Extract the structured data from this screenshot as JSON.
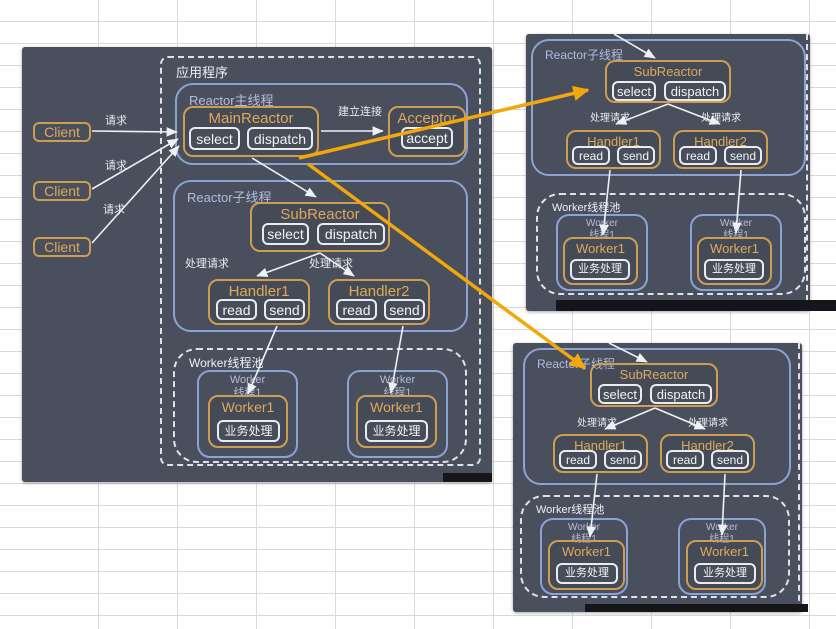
{
  "canvas": {
    "width": 836,
    "height": 629
  },
  "colors": {
    "panel_bg": "#4a4f5d",
    "orange_border": "#cf9d52",
    "orange_text": "#dfa958",
    "blue_border": "#8ba3d1",
    "blue_text": "#b0bddc",
    "white_text": "#eef0f3",
    "arrow_orange": "#f2a70a",
    "grid_line": "#d9d9d9"
  },
  "nodes": [
    {
      "t": "panel",
      "n": "main-diagram-panel",
      "r": [
        22,
        47,
        470,
        435
      ]
    },
    {
      "t": "strip",
      "n": "shadow-strip-main",
      "r": [
        443,
        473,
        49,
        9
      ]
    },
    {
      "t": "client",
      "n": "client-box-1",
      "tx": "Client",
      "r": [
        33,
        122,
        58,
        20
      ]
    },
    {
      "t": "client",
      "n": "client-box-2",
      "tx": "Client",
      "r": [
        33,
        181,
        58,
        20
      ]
    },
    {
      "t": "client",
      "n": "client-box-3",
      "tx": "Client",
      "r": [
        33,
        237,
        58,
        20
      ]
    },
    {
      "t": "text",
      "n": "request-label-1",
      "tx": "请求",
      "r": [
        100,
        113,
        32,
        13
      ]
    },
    {
      "t": "text",
      "n": "request-label-2",
      "tx": "请求",
      "r": [
        100,
        158,
        32,
        13
      ]
    },
    {
      "t": "text",
      "n": "request-label-3",
      "tx": "请求",
      "r": [
        98,
        202,
        32,
        13
      ]
    },
    {
      "t": "dashed",
      "n": "application-container",
      "tx": "应用程序",
      "r": [
        160,
        56,
        321,
        410
      ],
      "rad": 8
    },
    {
      "t": "blue",
      "n": "reactor-main-thread-container",
      "tx": "Reactor主线程",
      "r": [
        175,
        83,
        293,
        82
      ]
    },
    {
      "t": "orange",
      "n": "main-reactor-box",
      "tx": "MainReactor",
      "r": [
        183,
        106,
        136,
        51
      ],
      "fz": 15
    },
    {
      "t": "btn",
      "n": "select-button-main",
      "tx": "select",
      "r": [
        189,
        127,
        51,
        23
      ]
    },
    {
      "t": "btn",
      "n": "dispatch-button-main",
      "tx": "dispatch",
      "r": [
        247,
        127,
        66,
        23
      ]
    },
    {
      "t": "text",
      "n": "establish-connection-label",
      "tx": "建立连接",
      "r": [
        336,
        104,
        48,
        13
      ]
    },
    {
      "t": "orange",
      "n": "acceptor-box",
      "tx": "Acceptor",
      "r": [
        388,
        106,
        78,
        51
      ],
      "fz": 15
    },
    {
      "t": "btn",
      "n": "accept-button",
      "tx": "accept",
      "r": [
        401,
        127,
        52,
        22
      ]
    },
    {
      "t": "blue",
      "n": "reactor-sub-thread-container-main",
      "tx": "Reactor子线程",
      "r": [
        173,
        180,
        295,
        152
      ]
    },
    {
      "t": "orange",
      "n": "sub-reactor-box-main",
      "tx": "SubReactor",
      "r": [
        250,
        202,
        140,
        50
      ],
      "fz": 15
    },
    {
      "t": "btn",
      "n": "select-button-sub-main",
      "tx": "select",
      "r": [
        262,
        223,
        47,
        22
      ]
    },
    {
      "t": "btn",
      "n": "dispatch-button-sub-main",
      "tx": "dispatch",
      "r": [
        317,
        223,
        68,
        22
      ]
    },
    {
      "t": "text",
      "n": "handle-request-label-main-1",
      "tx": "处理请求",
      "r": [
        183,
        257,
        48,
        12
      ]
    },
    {
      "t": "text",
      "n": "handle-request-label-main-2",
      "tx": "处理请求",
      "r": [
        307,
        257,
        48,
        12
      ]
    },
    {
      "t": "orange",
      "n": "handler1-box-main",
      "tx": "Handler1",
      "r": [
        208,
        279,
        102,
        46
      ],
      "fz": 15
    },
    {
      "t": "btn",
      "n": "read-button-h1-main",
      "tx": "read",
      "r": [
        216,
        299,
        41,
        21
      ]
    },
    {
      "t": "btn",
      "n": "send-button-h1-main",
      "tx": "send",
      "r": [
        264,
        299,
        41,
        21
      ]
    },
    {
      "t": "orange",
      "n": "handler2-box-main",
      "tx": "Handler2",
      "r": [
        328,
        279,
        102,
        46
      ],
      "fz": 15
    },
    {
      "t": "btn",
      "n": "read-button-h2-main",
      "tx": "read",
      "r": [
        336,
        299,
        41,
        21
      ]
    },
    {
      "t": "btn",
      "n": "send-button-h2-main",
      "tx": "send",
      "r": [
        384,
        299,
        41,
        21
      ]
    },
    {
      "t": "dashed",
      "n": "worker-pool-main",
      "tx": "Worker线程池",
      "r": [
        173,
        348,
        294,
        115
      ],
      "fz": 12,
      "rad": 24
    },
    {
      "t": "bluebox",
      "n": "worker-thread-box-main-1",
      "tx": "Worker\n线程1",
      "r": [
        197,
        370,
        101,
        88
      ]
    },
    {
      "t": "orange",
      "n": "worker1-box-main-1",
      "tx": "Worker1",
      "r": [
        208,
        395,
        80,
        53
      ],
      "fz": 14
    },
    {
      "t": "btn",
      "n": "business-process-button-main-1",
      "tx": "业务处理",
      "r": [
        217,
        420,
        63,
        22
      ],
      "fz": 12
    },
    {
      "t": "bluebox",
      "n": "worker-thread-box-main-2",
      "tx": "Worker\n线程1",
      "r": [
        347,
        370,
        101,
        88
      ]
    },
    {
      "t": "orange",
      "n": "worker1-box-main-2",
      "tx": "Worker1",
      "r": [
        356,
        395,
        81,
        53
      ],
      "fz": 14
    },
    {
      "t": "btn",
      "n": "business-process-button-main-2",
      "tx": "业务处理",
      "r": [
        365,
        420,
        63,
        22
      ],
      "fz": 12
    },
    {
      "t": "panel",
      "n": "top-right-panel",
      "r": [
        526,
        34,
        284,
        277
      ]
    },
    {
      "t": "dashline",
      "n": "dashed-edge-top-right",
      "r": [
        806,
        34,
        3,
        277
      ]
    },
    {
      "t": "strip",
      "n": "shadow-strip-top-right",
      "r": [
        556,
        300,
        280,
        11
      ]
    },
    {
      "t": "blue",
      "n": "reactor-sub-thread-container-tr",
      "tx": "Reactor子线程",
      "r": [
        531,
        39,
        275,
        137
      ],
      "fz": 12
    },
    {
      "t": "orange",
      "n": "sub-reactor-box-tr",
      "tx": "SubReactor",
      "r": [
        605,
        60,
        126,
        43
      ],
      "fz": 13
    },
    {
      "t": "btn",
      "n": "select-button-tr",
      "tx": "select",
      "r": [
        612,
        81,
        44,
        20
      ],
      "fz": 13
    },
    {
      "t": "btn",
      "n": "dispatch-button-tr",
      "tx": "dispatch",
      "r": [
        664,
        81,
        62,
        20
      ],
      "fz": 13
    },
    {
      "t": "text",
      "n": "handle-request-label-tr-1",
      "tx": "处理请求",
      "r": [
        589,
        111,
        42,
        11
      ],
      "fz": 10
    },
    {
      "t": "text",
      "n": "handle-request-label-tr-2",
      "tx": "处理请求",
      "r": [
        700,
        111,
        42,
        11
      ],
      "fz": 10
    },
    {
      "t": "orange",
      "n": "handler1-box-tr",
      "tx": "Handler1",
      "r": [
        566,
        130,
        95,
        39
      ],
      "fz": 13
    },
    {
      "t": "btn",
      "n": "read-button-tr1",
      "tx": "read",
      "r": [
        572,
        146,
        38,
        19
      ],
      "fz": 12
    },
    {
      "t": "btn",
      "n": "send-button-tr1",
      "tx": "send",
      "r": [
        617,
        146,
        38,
        19
      ],
      "fz": 12
    },
    {
      "t": "orange",
      "n": "handler2-box-tr",
      "tx": "Handler2",
      "r": [
        673,
        130,
        95,
        39
      ],
      "fz": 13
    },
    {
      "t": "btn",
      "n": "read-button-tr2",
      "tx": "read",
      "r": [
        679,
        146,
        38,
        19
      ],
      "fz": 12
    },
    {
      "t": "btn",
      "n": "send-button-tr2",
      "tx": "send",
      "r": [
        724,
        146,
        38,
        19
      ],
      "fz": 12
    },
    {
      "t": "dashed",
      "n": "worker-pool-tr",
      "tx": "Worker线程池",
      "r": [
        536,
        193,
        270,
        102
      ],
      "fz": 11,
      "rad": 24
    },
    {
      "t": "bluebox",
      "n": "worker-thread-box-tr-1",
      "tx": "Worker\n线程1",
      "r": [
        556,
        214,
        92,
        77
      ],
      "fz": 10
    },
    {
      "t": "orange",
      "n": "worker1-box-tr-1",
      "tx": "Worker1",
      "r": [
        563,
        237,
        75,
        48
      ],
      "fz": 13
    },
    {
      "t": "btn",
      "n": "business-process-button-tr-1",
      "tx": "业务处理",
      "r": [
        570,
        259,
        60,
        21
      ],
      "fz": 11
    },
    {
      "t": "bluebox",
      "n": "worker-thread-box-tr-2",
      "tx": "Worker\n线程1",
      "r": [
        690,
        214,
        92,
        77
      ],
      "fz": 10
    },
    {
      "t": "orange",
      "n": "worker1-box-tr-2",
      "tx": "Worker1",
      "r": [
        697,
        237,
        75,
        48
      ],
      "fz": 13
    },
    {
      "t": "btn",
      "n": "business-process-button-tr-2",
      "tx": "业务处理",
      "r": [
        704,
        259,
        60,
        21
      ],
      "fz": 11
    },
    {
      "t": "panel",
      "n": "bottom-right-panel",
      "r": [
        513,
        343,
        289,
        269
      ]
    },
    {
      "t": "dashline",
      "n": "dashed-edge-bottom-right",
      "r": [
        798,
        343,
        3,
        268
      ]
    },
    {
      "t": "strip",
      "n": "shadow-strip-bottom-right",
      "r": [
        585,
        604,
        223,
        8
      ]
    },
    {
      "t": "blue",
      "n": "reactor-sub-thread-container-br",
      "tx": "Reactor子线程",
      "r": [
        523,
        348,
        268,
        137
      ],
      "fz": 12
    },
    {
      "t": "orange",
      "n": "sub-reactor-box-br",
      "tx": "SubReactor",
      "r": [
        590,
        363,
        128,
        44
      ],
      "fz": 13
    },
    {
      "t": "btn",
      "n": "select-button-br",
      "tx": "select",
      "r": [
        598,
        384,
        44,
        20
      ],
      "fz": 13
    },
    {
      "t": "btn",
      "n": "dispatch-button-br",
      "tx": "dispatch",
      "r": [
        650,
        384,
        62,
        20
      ],
      "fz": 13
    },
    {
      "t": "text",
      "n": "handle-request-label-br-1",
      "tx": "处理请求",
      "r": [
        576,
        416,
        42,
        11
      ],
      "fz": 10
    },
    {
      "t": "text",
      "n": "handle-request-label-br-2",
      "tx": "处理请求",
      "r": [
        687,
        416,
        42,
        11
      ],
      "fz": 10
    },
    {
      "t": "orange",
      "n": "handler1-box-br",
      "tx": "Handler1",
      "r": [
        553,
        434,
        95,
        39
      ],
      "fz": 13
    },
    {
      "t": "btn",
      "n": "read-button-br1",
      "tx": "read",
      "r": [
        559,
        450,
        38,
        19
      ],
      "fz": 12
    },
    {
      "t": "btn",
      "n": "send-button-br1",
      "tx": "send",
      "r": [
        604,
        450,
        38,
        19
      ],
      "fz": 12
    },
    {
      "t": "orange",
      "n": "handler2-box-br",
      "tx": "Handler2",
      "r": [
        660,
        434,
        95,
        39
      ],
      "fz": 13
    },
    {
      "t": "btn",
      "n": "read-button-br2",
      "tx": "read",
      "r": [
        666,
        450,
        38,
        19
      ],
      "fz": 12
    },
    {
      "t": "btn",
      "n": "send-button-br2",
      "tx": "send",
      "r": [
        711,
        450,
        38,
        19
      ],
      "fz": 12
    },
    {
      "t": "dashed",
      "n": "worker-pool-br",
      "tx": "Worker线程池",
      "r": [
        520,
        495,
        270,
        103
      ],
      "fz": 11,
      "rad": 24
    },
    {
      "t": "bluebox",
      "n": "worker-thread-box-br-1",
      "tx": "Worker\n线程1",
      "r": [
        540,
        518,
        88,
        77
      ],
      "fz": 10
    },
    {
      "t": "orange",
      "n": "worker1-box-br-1",
      "tx": "Worker1",
      "r": [
        548,
        540,
        77,
        50
      ],
      "fz": 13
    },
    {
      "t": "btn",
      "n": "business-process-button-br-1",
      "tx": "业务处理",
      "r": [
        556,
        563,
        62,
        21
      ],
      "fz": 11
    },
    {
      "t": "bluebox",
      "n": "worker-thread-box-br-2",
      "tx": "Worker\n线程1",
      "r": [
        678,
        518,
        88,
        77
      ],
      "fz": 10
    },
    {
      "t": "orange",
      "n": "worker1-box-br-2",
      "tx": "Worker1",
      "r": [
        686,
        540,
        77,
        50
      ],
      "fz": 13
    },
    {
      "t": "btn",
      "n": "business-process-button-br-2",
      "tx": "业务处理",
      "r": [
        694,
        563,
        62,
        21
      ],
      "fz": 11
    }
  ],
  "arrows": [
    {
      "x1": 92,
      "y1": 131,
      "x2": 177,
      "y2": 132,
      "c": "white"
    },
    {
      "x1": 92,
      "y1": 189,
      "x2": 178,
      "y2": 139,
      "c": "white"
    },
    {
      "x1": 92,
      "y1": 243,
      "x2": 179,
      "y2": 146,
      "c": "white"
    },
    {
      "x1": 321,
      "y1": 131,
      "x2": 383,
      "y2": 131,
      "c": "white"
    },
    {
      "x1": 252,
      "y1": 158,
      "x2": 316,
      "y2": 197,
      "c": "white"
    },
    {
      "x1": 320,
      "y1": 253,
      "x2": 257,
      "y2": 276,
      "c": "white"
    },
    {
      "x1": 320,
      "y1": 253,
      "x2": 354,
      "y2": 276,
      "c": "white"
    },
    {
      "x1": 277,
      "y1": 326,
      "x2": 248,
      "y2": 394,
      "c": "white"
    },
    {
      "x1": 403,
      "y1": 326,
      "x2": 391,
      "y2": 393,
      "c": "white"
    },
    {
      "x1": 614,
      "y1": 34,
      "x2": 655,
      "y2": 58,
      "c": "white"
    },
    {
      "x1": 668,
      "y1": 104,
      "x2": 616,
      "y2": 124,
      "c": "white"
    },
    {
      "x1": 668,
      "y1": 104,
      "x2": 720,
      "y2": 124,
      "c": "white"
    },
    {
      "x1": 610,
      "y1": 170,
      "x2": 603,
      "y2": 235,
      "c": "white"
    },
    {
      "x1": 741,
      "y1": 170,
      "x2": 736,
      "y2": 233,
      "c": "white"
    },
    {
      "x1": 609,
      "y1": 343,
      "x2": 647,
      "y2": 362,
      "c": "white"
    },
    {
      "x1": 655,
      "y1": 408,
      "x2": 605,
      "y2": 429,
      "c": "white"
    },
    {
      "x1": 655,
      "y1": 408,
      "x2": 705,
      "y2": 429,
      "c": "white"
    },
    {
      "x1": 597,
      "y1": 474,
      "x2": 590,
      "y2": 537,
      "c": "white"
    },
    {
      "x1": 725,
      "y1": 474,
      "x2": 722,
      "y2": 535,
      "c": "white"
    },
    {
      "x1": 299,
      "y1": 158,
      "x2": 588,
      "y2": 90,
      "c": "orange"
    },
    {
      "x1": 308,
      "y1": 164,
      "x2": 585,
      "y2": 368,
      "c": "orange"
    }
  ]
}
